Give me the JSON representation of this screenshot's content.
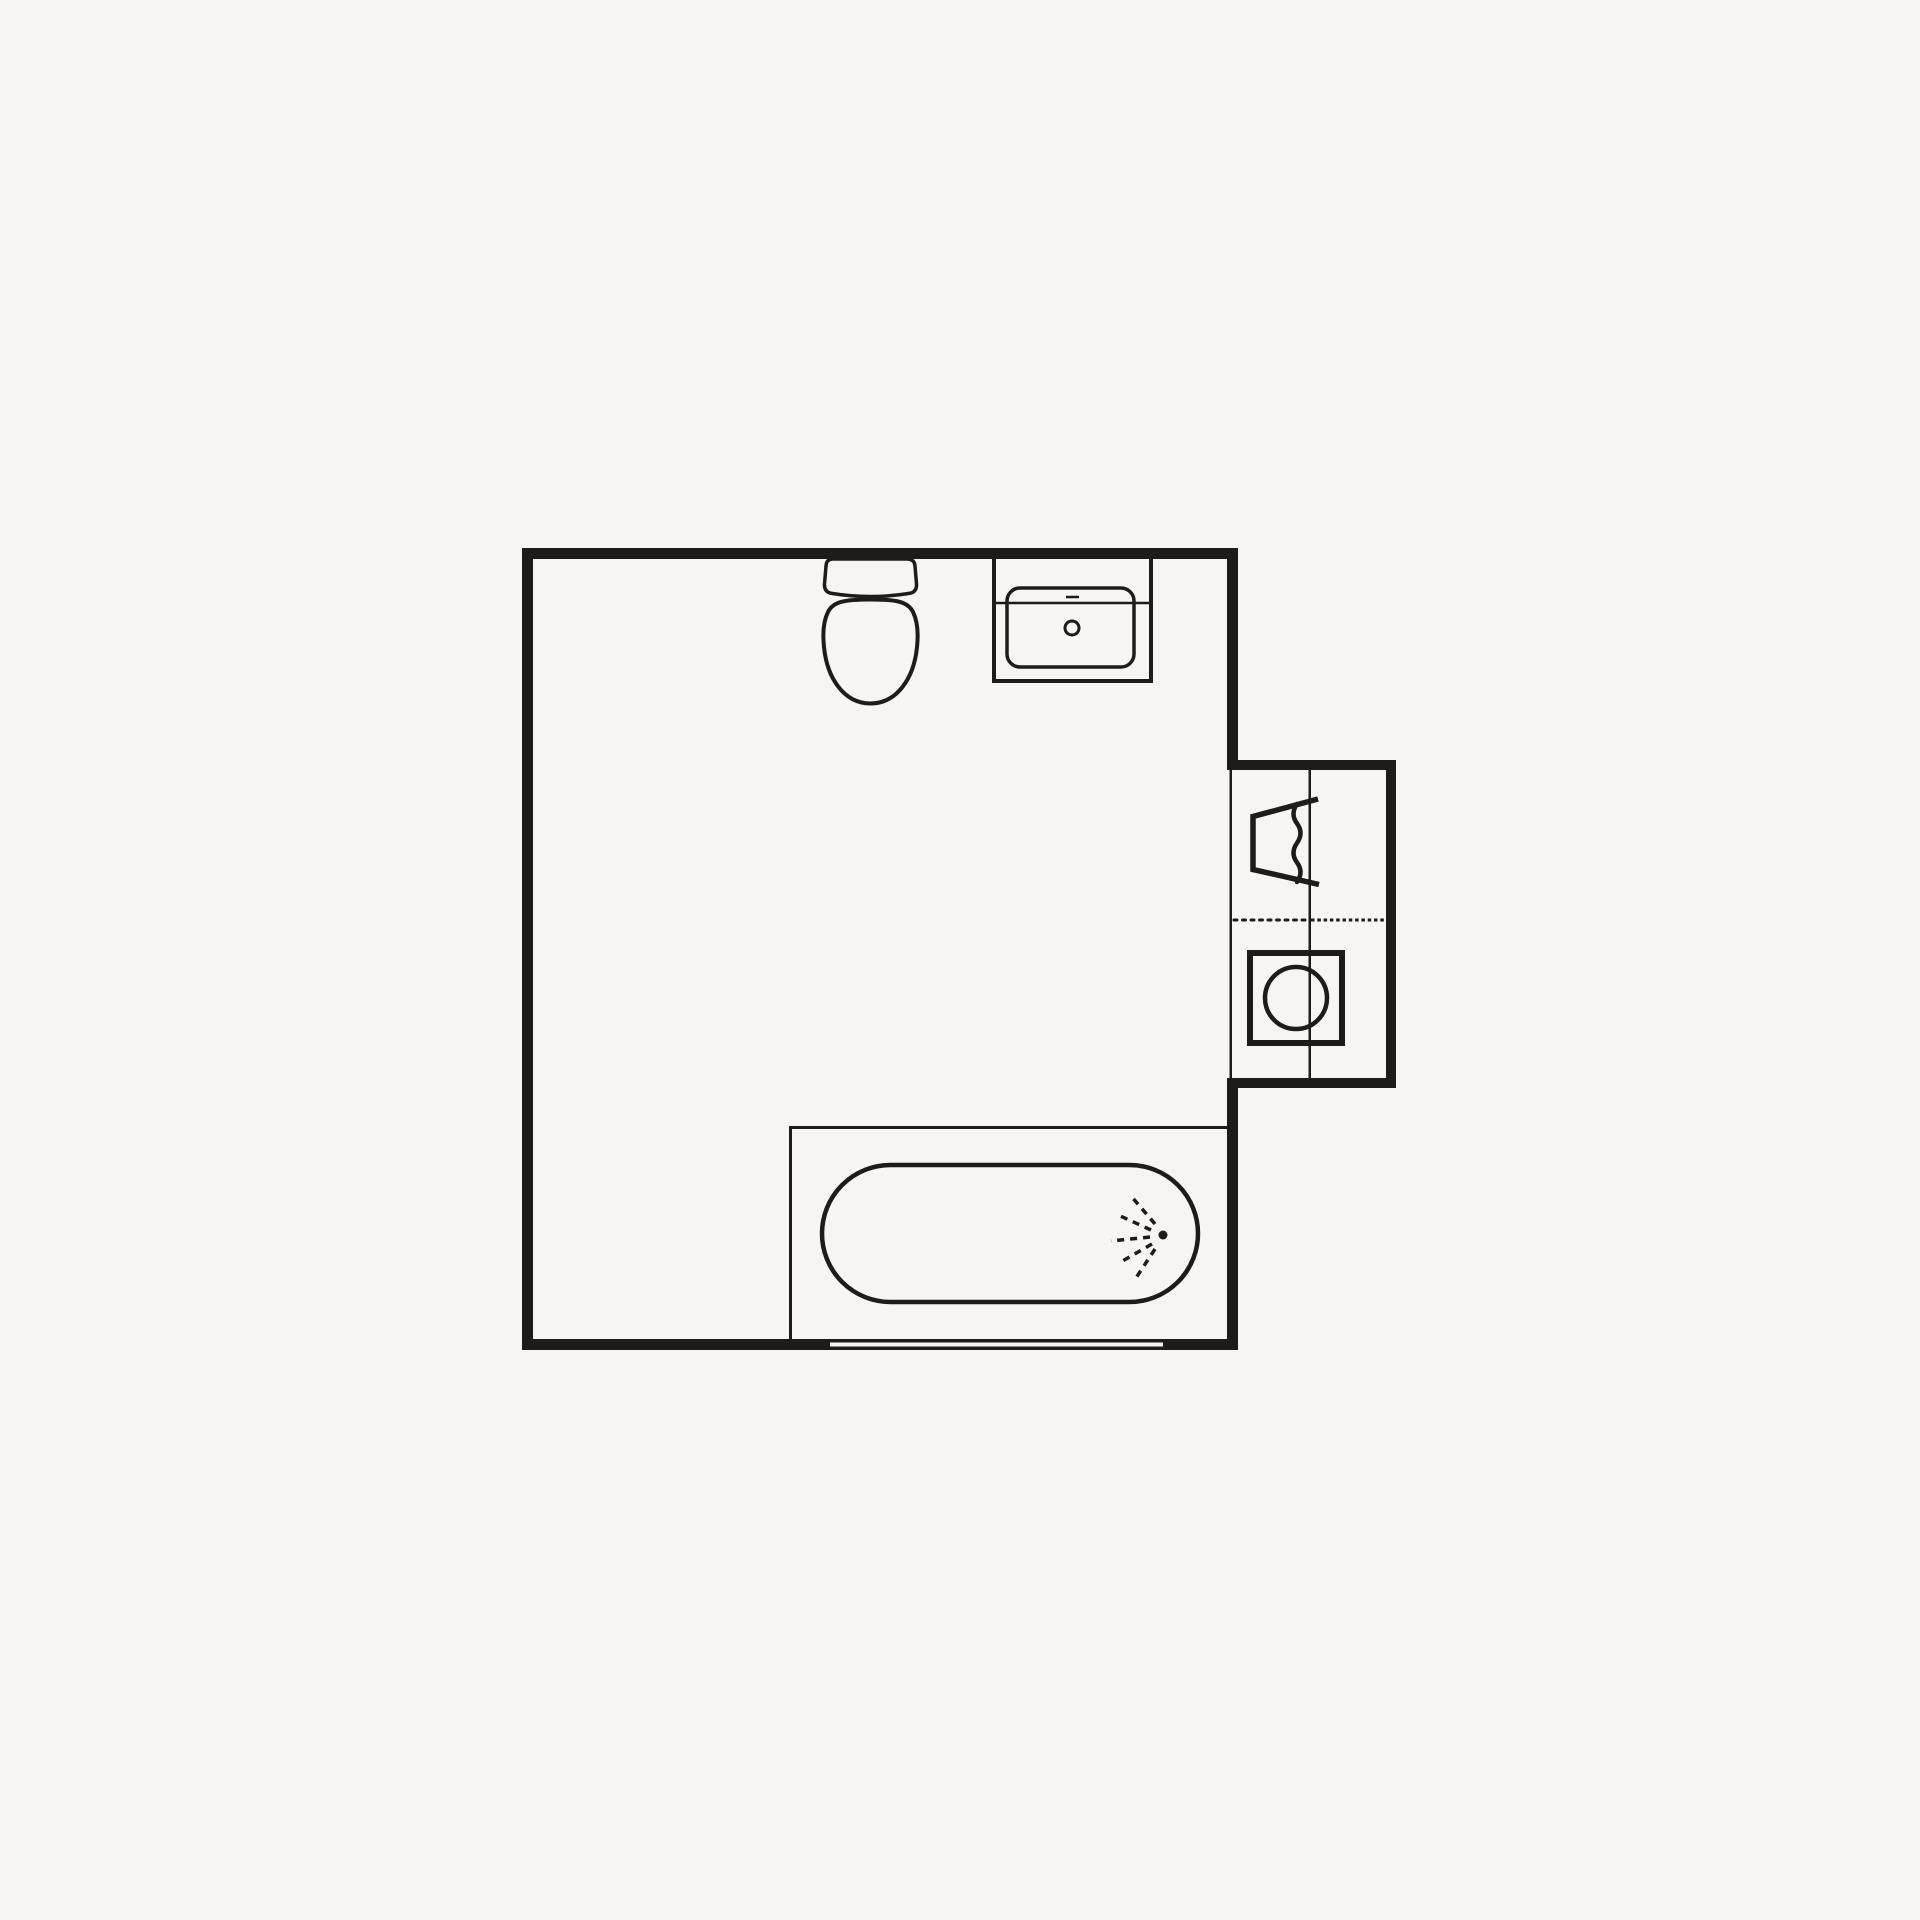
{
  "colors": {
    "background": "#f6f5f1",
    "line": "#1e1c1a"
  },
  "floorplan": {
    "kind": "bathroom-floor-plan",
    "canvas": {
      "width": 1920,
      "height": 1920
    },
    "fixtures": [
      "toilet",
      "washbasin",
      "bathtub-with-shower",
      "laundry-trough",
      "washing-machine",
      "window",
      "laundry-alcove"
    ],
    "shapes": [
      {
        "name": "room-wall-top",
        "type": "rect",
        "x": 522,
        "y": 548,
        "w": 716,
        "h": 11,
        "fill": "wall"
      },
      {
        "name": "room-wall-left",
        "type": "rect",
        "x": 522,
        "y": 548,
        "w": 11,
        "h": 802,
        "fill": "wall"
      },
      {
        "name": "room-wall-bottom",
        "type": "rect",
        "x": 522,
        "y": 1339,
        "w": 716,
        "h": 11,
        "fill": "wall"
      },
      {
        "name": "window-bottom-wall",
        "type": "rect",
        "x": 830,
        "y": 1342.5,
        "w": 333,
        "h": 4,
        "fill": "bg"
      },
      {
        "name": "room-wall-right-upper",
        "type": "rect",
        "x": 1227,
        "y": 548,
        "w": 11,
        "h": 218,
        "fill": "wall"
      },
      {
        "name": "room-wall-right-lower",
        "type": "rect",
        "x": 1227,
        "y": 1084,
        "w": 11,
        "h": 266,
        "fill": "wall"
      },
      {
        "name": "annex-wall-top",
        "type": "rect",
        "x": 1227,
        "y": 760,
        "w": 169,
        "h": 10,
        "fill": "wall"
      },
      {
        "name": "annex-wall-bottom",
        "type": "rect",
        "x": 1227,
        "y": 1078,
        "w": 169,
        "h": 10,
        "fill": "wall"
      },
      {
        "name": "annex-wall-right",
        "type": "rect",
        "x": 1386,
        "y": 760,
        "w": 10,
        "h": 328,
        "fill": "wall"
      },
      {
        "name": "annex-boundary-line",
        "type": "rect",
        "x": 1229.5,
        "y": 766,
        "w": 2.5,
        "h": 318,
        "fill": "wall"
      },
      {
        "name": "annex-divider-line",
        "type": "rect",
        "x": 1308.5,
        "y": 770,
        "w": 2.5,
        "h": 308,
        "fill": "wall"
      },
      {
        "name": "annex-dotted-line-left",
        "type": "line",
        "x1": 1234,
        "y1": 920,
        "x2": 1307,
        "y2": 920,
        "stroke": "wall",
        "sw": 3,
        "dash": "3 5.5",
        "cap": "round"
      },
      {
        "name": "annex-dotted-line-right",
        "type": "line",
        "x1": 1311,
        "y1": 920,
        "x2": 1386,
        "y2": 920,
        "stroke": "wall",
        "sw": 3,
        "dash": "3.5 2.8"
      },
      {
        "name": "laundry-trough-outline",
        "type": "path",
        "d": "M1318,799 L1253,816.5 L1253,869.5 L1319,884.5",
        "stroke": "wall",
        "sw": 5.5,
        "fill": "none",
        "join": "miter",
        "cap": "butt"
      },
      {
        "name": "laundry-trough-water-line",
        "type": "path",
        "d": "M1297,804 q-7,10 0,19.5 t0,19.5 t0,19.5 t0,19.5",
        "stroke": "wall",
        "sw": 4.5,
        "fill": "none",
        "cap": "round"
      },
      {
        "name": "washing-machine-body",
        "type": "rect",
        "x": 1250,
        "y": 953,
        "w": 92,
        "h": 90,
        "stroke": "wall",
        "sw": 6,
        "fill": "none"
      },
      {
        "name": "washing-machine-drum",
        "type": "circle",
        "cx": 1296,
        "cy": 998,
        "r": 31,
        "stroke": "wall",
        "sw": 4.5,
        "fill": "none"
      },
      {
        "name": "toilet-tank",
        "type": "path",
        "d": "M832,559 L908,559 Q914.5,559.5 915,566 L916.5,584 Q917,592.5 908.5,593.5 Q870,599.5 832.5,593.5 Q824,592.5 824.5,584 L826,566 Q826.5,559.5 832,559 Z",
        "stroke": "wall",
        "sw": 3.5,
        "fill": "none",
        "join": "round"
      },
      {
        "name": "toilet-bowl",
        "type": "path",
        "d": "M828,612 C833,601.5 845,599.5 870.5,599.5 C896,599.5 908,601.5 913,612 C917.5,621 918.5,633 917,647 C914,678 897,703.5 870.5,703.5 C844,703.5 827,678 824,647 C822.5,633 823.5,621 828,612 Z",
        "stroke": "wall",
        "sw": 4,
        "fill": "none"
      },
      {
        "name": "washbasin-counter",
        "type": "rect",
        "x": 994,
        "y": 551,
        "w": 157,
        "h": 130,
        "stroke": "wall",
        "sw": 4,
        "fill": "none"
      },
      {
        "name": "washbasin-shelf-line",
        "type": "line",
        "x1": 994,
        "y1": 603,
        "x2": 1151,
        "y2": 603,
        "stroke": "wall",
        "sw": 2.5
      },
      {
        "name": "washbasin-basin",
        "type": "rect",
        "x": 1007,
        "y": 588,
        "w": 127,
        "h": 79,
        "rx": 13,
        "stroke": "wall",
        "sw": 3.5,
        "fill": "none"
      },
      {
        "name": "washbasin-faucet-dash",
        "type": "line",
        "x1": 1066,
        "y1": 597,
        "x2": 1079,
        "y2": 597,
        "stroke": "wall",
        "sw": 2.5
      },
      {
        "name": "washbasin-drain",
        "type": "circle",
        "cx": 1072,
        "cy": 628,
        "r": 7,
        "stroke": "wall",
        "sw": 3,
        "fill": "none"
      },
      {
        "name": "tub-enclosure-top-line",
        "type": "rect",
        "x": 789,
        "y": 1126,
        "w": 438,
        "h": 3,
        "fill": "wall"
      },
      {
        "name": "tub-enclosure-left-line",
        "type": "rect",
        "x": 789,
        "y": 1126,
        "w": 3,
        "h": 213,
        "fill": "wall"
      },
      {
        "name": "bathtub",
        "type": "rect",
        "x": 822,
        "y": 1165,
        "w": 376,
        "h": 137,
        "rx": 68.5,
        "stroke": "wall",
        "sw": 4.5,
        "fill": "none"
      },
      {
        "name": "shower-origin-dot",
        "type": "circle",
        "cx": 1163,
        "cy": 1235,
        "r": 4.5,
        "fill": "wall"
      },
      {
        "name": "shower-spray-ray-1",
        "type": "line",
        "x1": 1155,
        "y1": 1224,
        "x2": 1131,
        "y2": 1196,
        "stroke": "wall",
        "sw": 3.5,
        "dash": "7 6"
      },
      {
        "name": "shower-spray-ray-2",
        "type": "line",
        "x1": 1151,
        "y1": 1230,
        "x2": 1116,
        "y2": 1214,
        "stroke": "wall",
        "sw": 3.5,
        "dash": "7 6"
      },
      {
        "name": "shower-spray-ray-3",
        "type": "line",
        "x1": 1150,
        "y1": 1237,
        "x2": 1111,
        "y2": 1241,
        "stroke": "wall",
        "sw": 3.5,
        "dash": "7 6"
      },
      {
        "name": "shower-spray-ray-4",
        "type": "line",
        "x1": 1152,
        "y1": 1244,
        "x2": 1119,
        "y2": 1263,
        "stroke": "wall",
        "sw": 3.5,
        "dash": "7 6"
      },
      {
        "name": "shower-spray-ray-5",
        "type": "line",
        "x1": 1155,
        "y1": 1249,
        "x2": 1134,
        "y2": 1281,
        "stroke": "wall",
        "sw": 3.5,
        "dash": "7 6"
      }
    ]
  }
}
